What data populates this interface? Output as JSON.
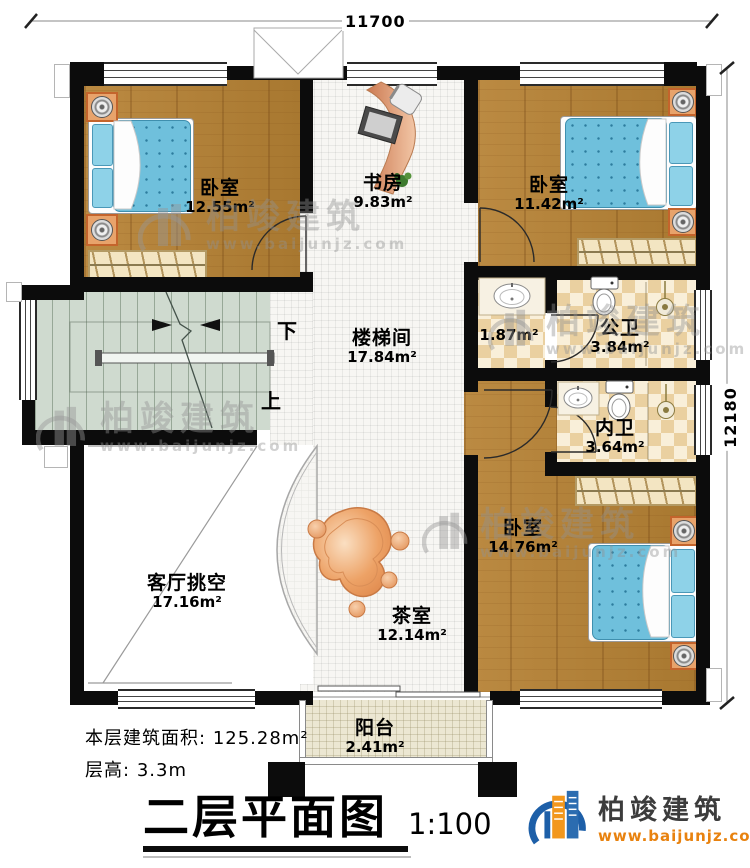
{
  "dimensions": {
    "top": "11700",
    "right": "12180"
  },
  "rooms": [
    {
      "id": "bedroom-top-left",
      "name": "卧室",
      "area": "12.55m²"
    },
    {
      "id": "study",
      "name": "书房",
      "area": "9.83m²"
    },
    {
      "id": "bedroom-top-right",
      "name": "卧室",
      "area": "11.42m²"
    },
    {
      "id": "stairwell",
      "name": "楼梯间",
      "area": "17.84m²"
    },
    {
      "id": "washbasin-area",
      "name": "",
      "area": "1.87m²"
    },
    {
      "id": "public-bathroom",
      "name": "公卫",
      "area": "3.84m²"
    },
    {
      "id": "private-bathroom",
      "name": "内卫",
      "area": "3.64m²"
    },
    {
      "id": "bedroom-bottom",
      "name": "卧室",
      "area": "14.76m²"
    },
    {
      "id": "living-room-void",
      "name": "客厅挑空",
      "area": "17.16m²"
    },
    {
      "id": "tea-room",
      "name": "茶室",
      "area": "12.14m²"
    },
    {
      "id": "balcony",
      "name": "阳台",
      "area": "2.41m²"
    }
  ],
  "stairs": {
    "down": "下",
    "up": "上"
  },
  "notes": {
    "floor_area_label": "本层建筑面积:",
    "floor_area_value": "125.28m²",
    "storey_height_label": "层高:",
    "storey_height_value": "3.3m"
  },
  "title": {
    "text": "二层平面图",
    "scale": "1:100"
  },
  "brand": {
    "name": "柏竣建筑",
    "url": "www.baijunjz.com"
  },
  "watermark": {
    "name": "柏竣建筑",
    "url": "www.baijunjz.com"
  },
  "colors": {
    "wall": "#0c0c0c",
    "wood_floor": "#b5823a",
    "tile_floor": "#f7f6f3",
    "checker_tile": "#ead0a0",
    "stair": "#cfdacf",
    "balcony_tile": "#ece7d2",
    "bed_blue": "#6fc0dc",
    "nightstand_orange": "#e8a36b",
    "desk_salmon": "#e09a6a",
    "brand_orange": "#e8820f",
    "brand_dark": "#3c3c3c"
  }
}
